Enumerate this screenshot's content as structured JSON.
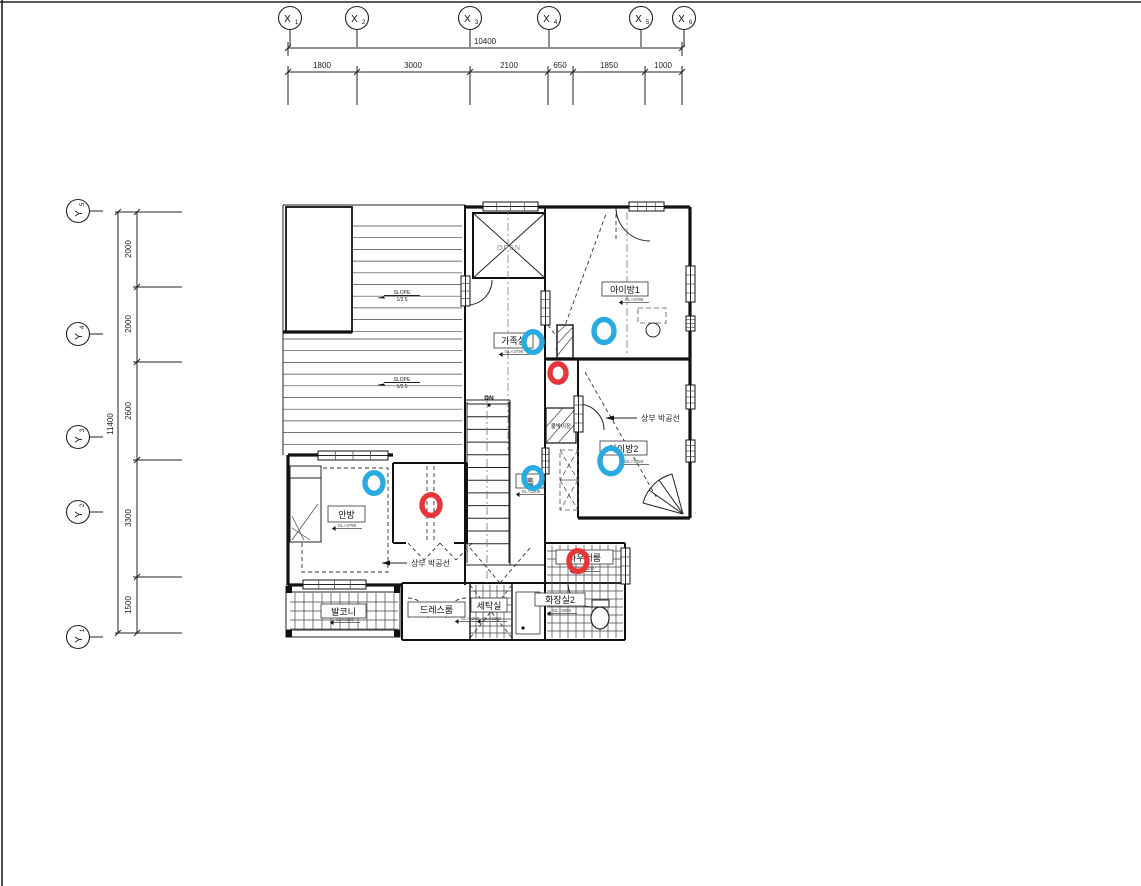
{
  "grid_x": {
    "total": "10400",
    "bubbles": [
      {
        "label": "X",
        "sub": "1"
      },
      {
        "label": "X",
        "sub": "2"
      },
      {
        "label": "X",
        "sub": "3"
      },
      {
        "label": "X",
        "sub": "4"
      },
      {
        "label": "X",
        "sub": "5"
      },
      {
        "label": "X",
        "sub": "6"
      }
    ],
    "segments": [
      "1800",
      "3000",
      "2100",
      "650",
      "1850",
      "1000"
    ]
  },
  "grid_y": {
    "total": "11400",
    "bubbles": [
      {
        "label": "Y",
        "sub": "5"
      },
      {
        "label": "Y",
        "sub": "4"
      },
      {
        "label": "Y",
        "sub": "3"
      },
      {
        "label": "Y",
        "sub": "2"
      },
      {
        "label": "Y",
        "sub": "1"
      }
    ],
    "segments": [
      "2000",
      "2000",
      "2600",
      "3300",
      "1500"
    ]
  },
  "plan": {
    "rooms": [
      {
        "name": "family-room",
        "label": "가족실"
      },
      {
        "name": "kids-room-1",
        "label": "아이방1"
      },
      {
        "name": "kids-room-2",
        "label": "아이방2"
      },
      {
        "name": "master-bedroom",
        "label": "안방"
      },
      {
        "name": "dress-room",
        "label": "드레스룸"
      },
      {
        "name": "balcony",
        "label": "발코니"
      },
      {
        "name": "laundry",
        "label": "세탁실"
      },
      {
        "name": "bathroom-2",
        "label": "화장실2"
      },
      {
        "name": "powder-room",
        "label": "파우더룸"
      },
      {
        "name": "hall",
        "label": "홀"
      },
      {
        "name": "built-in-closet",
        "label": "붙박이장"
      }
    ],
    "levels": [
      "GL+3790",
      "GL+3790",
      "GL+3050",
      "GL+3790",
      "GL+3200",
      "GL+3200",
      "GL+3200",
      "GL+3200",
      "GL+3050",
      "GL+3200"
    ],
    "annotations": {
      "gable": "상부 박공선",
      "slope_label": "SLOPE",
      "slope_ratio": "1/2.5",
      "open": "OPEN",
      "dn": "DN"
    },
    "markers": [
      {
        "type": "blue",
        "x": 533,
        "y": 342,
        "r": 9
      },
      {
        "type": "blue",
        "x": 604,
        "y": 331,
        "r": 10
      },
      {
        "type": "blue",
        "x": 611,
        "y": 461,
        "r": 11
      },
      {
        "type": "blue",
        "x": 374,
        "y": 483,
        "r": 9
      },
      {
        "type": "blue",
        "x": 533,
        "y": 478,
        "r": 9
      },
      {
        "type": "red",
        "x": 558,
        "y": 373,
        "r": 8
      },
      {
        "type": "red",
        "x": 431,
        "y": 505,
        "r": 9
      },
      {
        "type": "red",
        "x": 578,
        "y": 561,
        "r": 9
      }
    ],
    "colors": {
      "blue": "#29ABE2",
      "red": "#E8353A"
    }
  }
}
